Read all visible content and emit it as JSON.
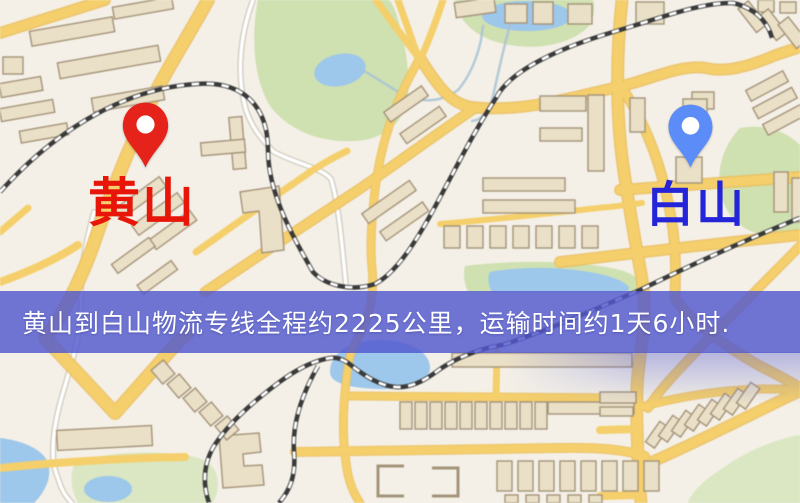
{
  "map": {
    "origin_marker": {
      "label": "黄山",
      "pin_color": "#e5231b",
      "label_color": "#e81608",
      "icon": "red-map-pin-icon"
    },
    "dest_marker": {
      "label": "白山",
      "pin_color": "#5b8cf7",
      "label_color": "#2424d8",
      "icon": "blue-map-pin-icon"
    },
    "banner": {
      "text": "黄山到白山物流专线全程约2225公里，运输时间约1天6小时.",
      "bg_color": "rgba(82,88,206,0.82)",
      "text_color": "#ffffff"
    },
    "route": {
      "distance_km": "2225",
      "duration": "1天6小时"
    },
    "palette": {
      "background": "#f4f0e7",
      "road": "#f3cf6e",
      "road_casing": "#e9bd5e",
      "building_fill": "#eae0c8",
      "building_stroke": "#a4937a",
      "park": "#cfe0b2",
      "water": "#9ec7ea",
      "railway": "#3a3a3a"
    }
  }
}
